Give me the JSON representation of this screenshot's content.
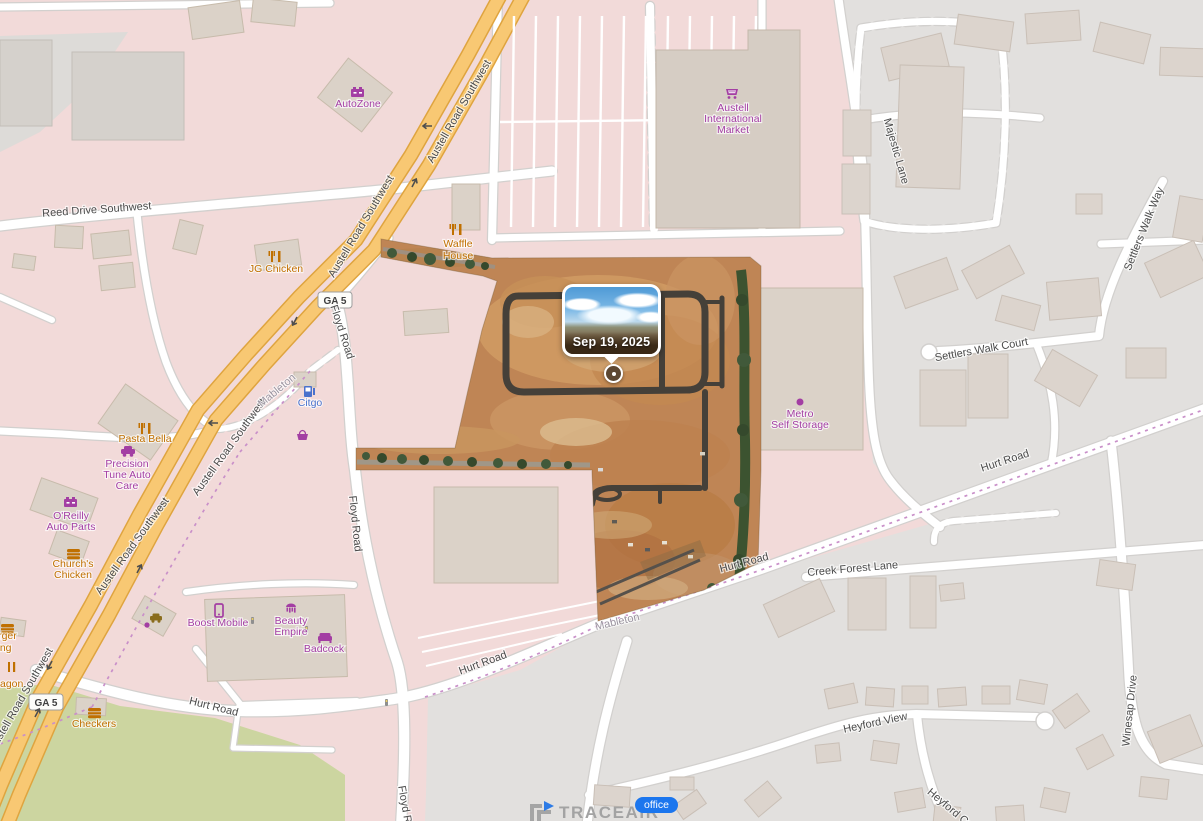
{
  "popup": {
    "date": "Sep 19, 2025"
  },
  "watermark": {
    "brand": "TRACEAIR",
    "office_label": "office"
  },
  "map": {
    "shields": [
      "GA 5",
      "GA 5"
    ],
    "road_labels": [
      {
        "text": "Reed Drive Southwest"
      },
      {
        "text": "Austell Road Southwest"
      },
      {
        "text": "Austell Road Southwest"
      },
      {
        "text": "Austell Road Southwest"
      },
      {
        "text": "Austell Road Southwest"
      },
      {
        "text": "Austell Road Southwest"
      },
      {
        "text": "Floyd Road"
      },
      {
        "text": "Floyd Road"
      },
      {
        "text": "Floyd Road"
      },
      {
        "text": "Hurt Road"
      },
      {
        "text": "Hurt Road"
      },
      {
        "text": "Hurt Road"
      },
      {
        "text": "Hurt Road"
      },
      {
        "text": "Creek Forest Lane"
      },
      {
        "text": "Majestic Lane"
      },
      {
        "text": "Settlers Walk Way"
      },
      {
        "text": "Settlers Walk Court"
      },
      {
        "text": "Heyford View"
      },
      {
        "text": "Heyford Co"
      },
      {
        "text": "Winesap Drive"
      },
      {
        "text": "Mableton"
      },
      {
        "text": "Mableton"
      }
    ],
    "pois": [
      {
        "name": "AutoZone",
        "lines": [
          "AutoZone"
        ]
      },
      {
        "name": "Waffle House",
        "lines": [
          "Waffle",
          "House"
        ]
      },
      {
        "name": "JG Chicken",
        "lines": [
          "JG Chicken"
        ]
      },
      {
        "name": "Austell International Market",
        "lines": [
          "Austell",
          "International",
          "Market"
        ]
      },
      {
        "name": "Metro Self Storage",
        "lines": [
          "Metro",
          "Self Storage"
        ]
      },
      {
        "name": "Citgo",
        "lines": [
          "Citgo"
        ]
      },
      {
        "name": "Pasta Bella",
        "lines": [
          "Pasta Bella"
        ]
      },
      {
        "name": "Precision Tune Auto Care",
        "lines": [
          "Precision",
          "Tune Auto",
          "Care"
        ]
      },
      {
        "name": "O'Reilly Auto Parts",
        "lines": [
          "O'Reilly",
          "Auto Parts"
        ]
      },
      {
        "name": "Church's Chicken",
        "lines": [
          "Church's",
          "Chicken"
        ]
      },
      {
        "name": "Boost Mobile",
        "lines": [
          "Boost Mobile"
        ]
      },
      {
        "name": "Beauty Empire",
        "lines": [
          "Beauty",
          "Empire"
        ]
      },
      {
        "name": "Badcock",
        "lines": [
          "Badcock"
        ]
      },
      {
        "name": "Burger King",
        "lines": [
          "Burger",
          "King"
        ]
      },
      {
        "name": "Checkers",
        "lines": [
          "Checkers"
        ]
      },
      {
        "name": "agon",
        "lines": [
          "agon"
        ]
      }
    ],
    "colors": {
      "residential_pink": "#f2dad9",
      "urban_gray": "#e2e0de",
      "scrub_green": "#ccd5a0",
      "highway_yellow": "#f8c873",
      "highway_casing": "#dfa43f",
      "boundary_pink": "#c98fc9",
      "site_dirt": "#bf8555",
      "site_asphalt": "#454039",
      "poi_purple": "#a33ea3",
      "poi_orange": "#c07000",
      "poi_blue": "#4a72cc",
      "badge_blue": "#1b76ee"
    }
  }
}
